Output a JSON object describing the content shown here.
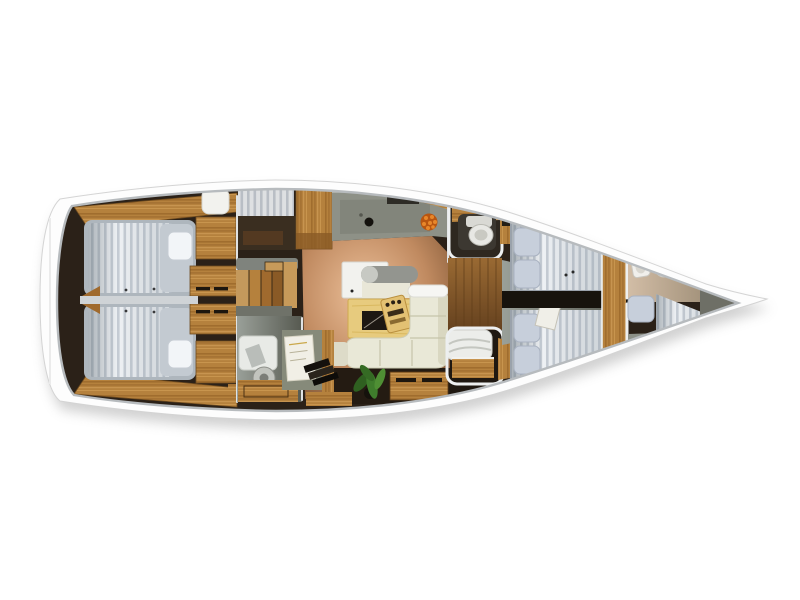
{
  "scene": {
    "type": "yacht-interior-floor-plan",
    "view": "top-down-cutaway-render",
    "orientation": "bow-right-stern-left",
    "background": "#ffffff",
    "text_visible": "none"
  },
  "palette": {
    "bg": "#ffffff",
    "hull": "#fdfdfd",
    "hullEdge": "#d4d4d4",
    "seam": "#b7bbbe",
    "interiorDark": "#2b2118",
    "woodLight": "#c79a5a",
    "woodMid": "#b5813d",
    "woodDark": "#8a5a26",
    "floorTan": "#c08a60",
    "floorGray": "#8d9188",
    "counterGray": "#8e9187",
    "mattressBase": "#eef1f4",
    "mattressStripe": "#c5ccd4",
    "pillow": "#c7cfdb",
    "sofaCream": "#e9e8d7",
    "tableWood": "#e7cb7e",
    "tableInlay": "#1d1813",
    "plantGreen": "#3f7d2c",
    "fruitOrange": "#c05f14",
    "fixtureWhite": "#f2f2ee"
  },
  "regions": [
    {
      "id": "aft-cabin-port",
      "contents": "double berth with striped mattress, white pillow, wood wardrobes"
    },
    {
      "id": "aft-cabin-starboard",
      "contents": "double berth with striped mattress, white pillow, wood wardrobes"
    },
    {
      "id": "companionway",
      "contents": "wood stairs, gray landings, utility room with bench and round machine"
    },
    {
      "id": "galley",
      "contents": "gray L-counter, sink, dark stove block, fruit bowl, wood cabinets"
    },
    {
      "id": "saloon",
      "contents": "white sideboard with gray roll cushion, wood table with dark inlay, game board, L-shaped cream sofa, green plant, chart desk with papers and books"
    },
    {
      "id": "mid-head",
      "contents": "toilet with wood shelf"
    },
    {
      "id": "mid-berth",
      "contents": "molded white seat with wood drawers"
    },
    {
      "id": "forward-cabin",
      "contents": "V-berths with striped mattresses, two blue-gray pillows each, white tray, wood divider bulkhead"
    },
    {
      "id": "forward-head",
      "contents": "tan floor, two white wash basins, dark hull locker band"
    },
    {
      "id": "bow-berth",
      "contents": "tapered striped berth with pillow"
    }
  ]
}
